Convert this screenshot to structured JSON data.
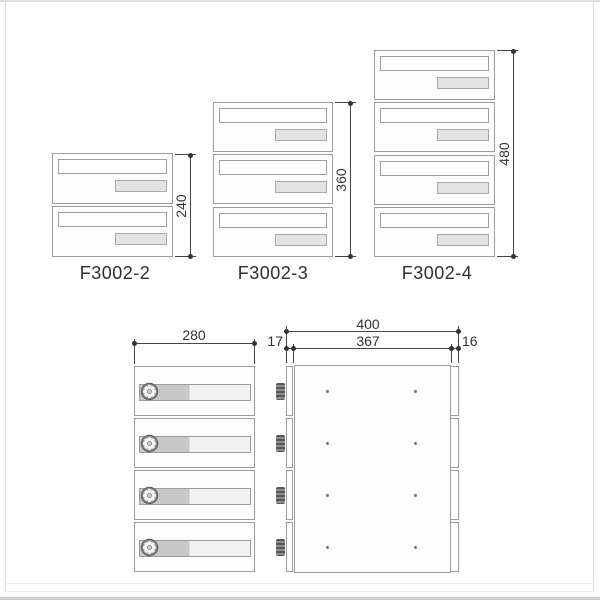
{
  "products": [
    {
      "model": "F3002-2",
      "units": 2,
      "height_label": "240"
    },
    {
      "model": "F3002-3",
      "units": 3,
      "height_label": "360"
    },
    {
      "model": "F3002-4",
      "units": 4,
      "height_label": "480"
    }
  ],
  "detail_front": {
    "width_label": "280",
    "units": 4
  },
  "detail_side": {
    "total_depth_label": "400",
    "body_depth_label": "367",
    "door_depth_label": "17",
    "back_depth_label": "16",
    "units": 4
  },
  "colors": {
    "outline": "#9c9c9c",
    "dimension_line": "#454545",
    "text": "#2f2f2f",
    "plate_fill": "#e3e3e3",
    "bar_left_fill": "#c8c8c8",
    "bar_right_fill": "#f1f1f1",
    "knob_fill": "#6a6a6a",
    "background": "#fefefe"
  }
}
